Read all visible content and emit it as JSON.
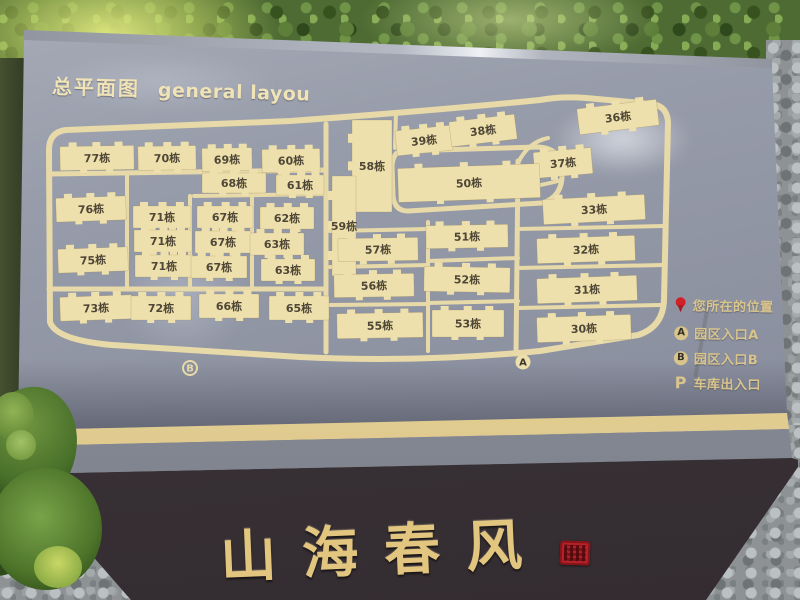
{
  "sign": {
    "title_zh": "总平面图",
    "title_en": "general layou",
    "plaque_text": "山海春风",
    "legend": [
      {
        "icon": "you-are-here-pin",
        "marker": "",
        "label": "您所在的位置"
      },
      {
        "icon": "circle-letter",
        "marker": "A",
        "label": "园区入口A"
      },
      {
        "icon": "circle-letter",
        "marker": "B",
        "label": "园区入口B"
      },
      {
        "icon": "letter",
        "marker": "P",
        "label": "车库出入口"
      }
    ]
  },
  "map": {
    "building_suffix": "栋",
    "buildings": [
      {
        "label": "77栋",
        "x": 60,
        "y": 146,
        "w": 74,
        "h": 24,
        "r": -1
      },
      {
        "label": "70栋",
        "x": 138,
        "y": 146,
        "w": 58,
        "h": 24,
        "r": -1
      },
      {
        "label": "69栋",
        "x": 202,
        "y": 148,
        "w": 50,
        "h": 23,
        "r": -1
      },
      {
        "label": "60栋",
        "x": 262,
        "y": 149,
        "w": 58,
        "h": 23,
        "r": -1
      },
      {
        "label": "68栋",
        "x": 202,
        "y": 173,
        "w": 64,
        "h": 20,
        "r": 0
      },
      {
        "label": "61栋",
        "x": 276,
        "y": 175,
        "w": 48,
        "h": 20,
        "r": 0
      },
      {
        "label": "39栋",
        "x": 396,
        "y": 128,
        "w": 56,
        "h": 25,
        "r": -6
      },
      {
        "label": "38栋",
        "x": 450,
        "y": 118,
        "w": 66,
        "h": 25,
        "r": -7
      },
      {
        "label": "36栋",
        "x": 578,
        "y": 104,
        "w": 80,
        "h": 26,
        "r": -7
      },
      {
        "label": "58栋",
        "x": 352,
        "y": 120,
        "w": 40,
        "h": 92,
        "r": 0
      },
      {
        "label": "37栋",
        "x": 534,
        "y": 150,
        "w": 58,
        "h": 26,
        "r": -5
      },
      {
        "label": "50栋",
        "x": 398,
        "y": 166,
        "w": 142,
        "h": 34,
        "r": -2
      },
      {
        "label": "59栋",
        "x": 332,
        "y": 176,
        "w": 24,
        "h": 100,
        "r": 0
      },
      {
        "label": "76栋",
        "x": 56,
        "y": 197,
        "w": 70,
        "h": 24,
        "r": -2
      },
      {
        "label": "75栋",
        "x": 58,
        "y": 248,
        "w": 70,
        "h": 24,
        "r": -2
      },
      {
        "label": "73栋",
        "x": 60,
        "y": 296,
        "w": 72,
        "h": 24,
        "r": -2
      },
      {
        "label": "71栋",
        "x": 133,
        "y": 206,
        "w": 58,
        "h": 22,
        "r": 0
      },
      {
        "label": "71栋",
        "x": 134,
        "y": 230,
        "w": 58,
        "h": 22,
        "r": 0
      },
      {
        "label": "71栋",
        "x": 135,
        "y": 255,
        "w": 58,
        "h": 22,
        "r": 0
      },
      {
        "label": "67栋",
        "x": 197,
        "y": 206,
        "w": 56,
        "h": 22,
        "r": 0
      },
      {
        "label": "67栋",
        "x": 195,
        "y": 231,
        "w": 56,
        "h": 22,
        "r": 0
      },
      {
        "label": "67栋",
        "x": 191,
        "y": 256,
        "w": 56,
        "h": 22,
        "r": 0
      },
      {
        "label": "62栋",
        "x": 260,
        "y": 207,
        "w": 54,
        "h": 22,
        "r": 0
      },
      {
        "label": "63栋",
        "x": 250,
        "y": 233,
        "w": 54,
        "h": 22,
        "r": 0
      },
      {
        "label": "63栋",
        "x": 261,
        "y": 259,
        "w": 54,
        "h": 22,
        "r": 0
      },
      {
        "label": "72栋",
        "x": 131,
        "y": 296,
        "w": 60,
        "h": 24,
        "r": 0
      },
      {
        "label": "66栋",
        "x": 199,
        "y": 294,
        "w": 60,
        "h": 24,
        "r": 0
      },
      {
        "label": "65栋",
        "x": 269,
        "y": 296,
        "w": 60,
        "h": 24,
        "r": 0
      },
      {
        "label": "57栋",
        "x": 338,
        "y": 238,
        "w": 80,
        "h": 23,
        "r": -1
      },
      {
        "label": "56栋",
        "x": 334,
        "y": 274,
        "w": 80,
        "h": 23,
        "r": -1
      },
      {
        "label": "55栋",
        "x": 337,
        "y": 313,
        "w": 86,
        "h": 25,
        "r": -1
      },
      {
        "label": "51栋",
        "x": 426,
        "y": 225,
        "w": 82,
        "h": 23,
        "r": -1
      },
      {
        "label": "52栋",
        "x": 424,
        "y": 267,
        "w": 86,
        "h": 25,
        "r": 1
      },
      {
        "label": "53栋",
        "x": 432,
        "y": 310,
        "w": 72,
        "h": 27,
        "r": 0
      },
      {
        "label": "33栋",
        "x": 543,
        "y": 197,
        "w": 102,
        "h": 25,
        "r": -3
      },
      {
        "label": "32栋",
        "x": 537,
        "y": 237,
        "w": 98,
        "h": 25,
        "r": -2
      },
      {
        "label": "31栋",
        "x": 537,
        "y": 277,
        "w": 100,
        "h": 25,
        "r": -2
      },
      {
        "label": "30栋",
        "x": 537,
        "y": 316,
        "w": 94,
        "h": 25,
        "r": -2
      }
    ],
    "entrance_markers": [
      {
        "label": "A",
        "x": 523,
        "y": 362,
        "style": "solid"
      },
      {
        "label": "B",
        "x": 190,
        "y": 368,
        "style": "ring"
      }
    ]
  },
  "colors": {
    "panel": "#8e93a2",
    "building": "#eee0ac",
    "road": "#e7d9a8",
    "dark_text": "#4e4636",
    "gold_text": "#d9c48c",
    "seal_red": "#b4232b",
    "plinth": "#3c343a"
  }
}
